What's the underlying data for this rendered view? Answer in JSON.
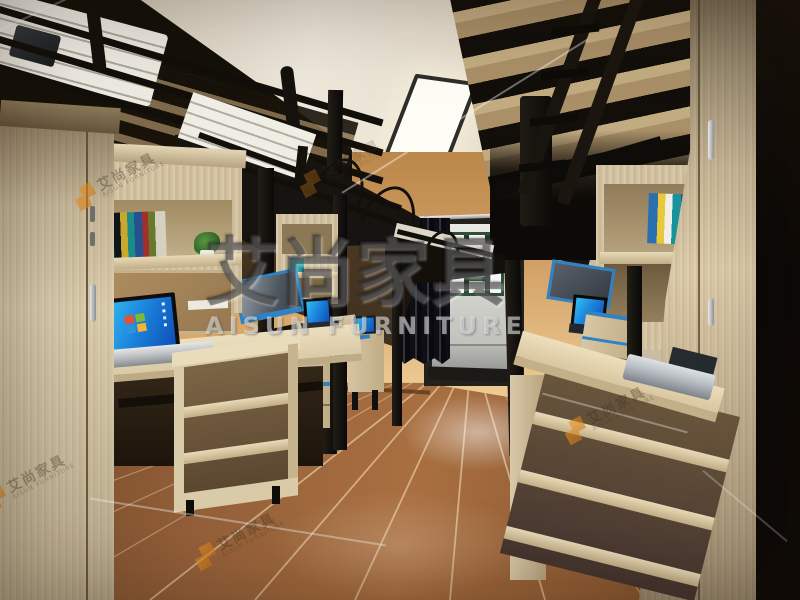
{
  "scene": {
    "description": "3D interior render of a student dormitory room with black metal loft beds above desks, wardrobes, open shelving, laptops and a curtained balcony door",
    "room": {
      "wall_color": "#d2a064",
      "ceiling_color": "#eae2d3",
      "floor_wood_color": "#96613a",
      "balcony_floor_color": "#b3b3af",
      "window_frame_color": "#2e5038",
      "curtain_color": "#15151c"
    },
    "furniture": {
      "frame_metal_color": "#16130f",
      "wood_color": "#d3c3a1",
      "accent_trim_color": "#2f82c4",
      "laptop_screen_color": "#1a8ad8",
      "laptop_body_color": "#b7bdc2"
    }
  },
  "watermark": {
    "brand_zh": "艾尚家具",
    "brand_en": "AISUN FURNITURE",
    "logo_color": "#e8921e"
  }
}
